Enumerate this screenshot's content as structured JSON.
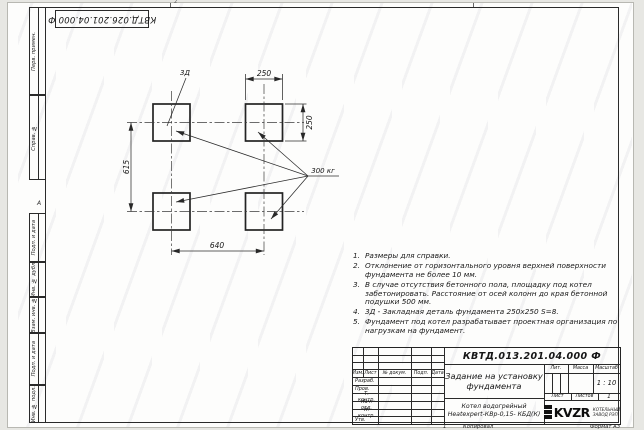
{
  "sheet": {
    "top_stamp": "КВТД.026.201.04.000 Ф",
    "fold_label": "2",
    "zone_label": "А",
    "margin_boxes": [
      "Перв. примен.",
      "Справ. №",
      "Подп. и дата",
      "Инв. № дубл.",
      "Взам. инв. №",
      "Подп. и дата",
      "Инв. № подл."
    ],
    "footer": {
      "sheet_num": "1",
      "copied": "Копировал",
      "format": "Формат А3"
    }
  },
  "drawing": {
    "detail_label": "3Д",
    "load_label": "300 кг",
    "dim_top": "250",
    "dim_right": "250",
    "dim_left": "615",
    "dim_bottom": "640"
  },
  "notes": [
    {
      "n": "1.",
      "text": "Размеры для справки."
    },
    {
      "n": "2.",
      "text": "Отклонение от горизонтального уровня верхней поверхности фундамента не более 10 мм."
    },
    {
      "n": "3.",
      "text": "В случае отсутствия бетонного пола, площадку под котел забетонировать. Расстояние от осей колонн до края бетонной подушки 500 мм."
    },
    {
      "n": "4.",
      "text": "3Д - Закладная деталь фундамента 250х250 S=8."
    },
    {
      "n": "5.",
      "text": "Фундамент под котел разрабатывает проектная организация по нагрузкам на фундамент."
    }
  ],
  "title_block": {
    "doc_number": "КВТД.013.201.04.000 Ф",
    "title_line1": "Задание на установку",
    "title_line2": "фундамента",
    "product_line1": "Котел водогрейный",
    "product_line2": "Heatexpert-КВр-0,15- КБД(К)",
    "header_cols": [
      "Изм.",
      "Лист",
      "№ докум.",
      "Подп.",
      "Дата"
    ],
    "sign_rows": [
      "Разраб.",
      "Пров.",
      "Т. контр.",
      "Нач. отд.",
      "Н. контр.",
      "Утв."
    ],
    "lit_label": "Лит.",
    "mass_label": "Масса",
    "scale_label": "Масштаб",
    "scale_value": "1 : 10",
    "sheet_label": "Лист",
    "sheets_label": "Листов",
    "sheets_value": "1",
    "logo_text": "KVZR",
    "logo_caption1": "КОТЕЛЬНЫЙ",
    "logo_caption2": "ЗАВОД РЭП"
  }
}
